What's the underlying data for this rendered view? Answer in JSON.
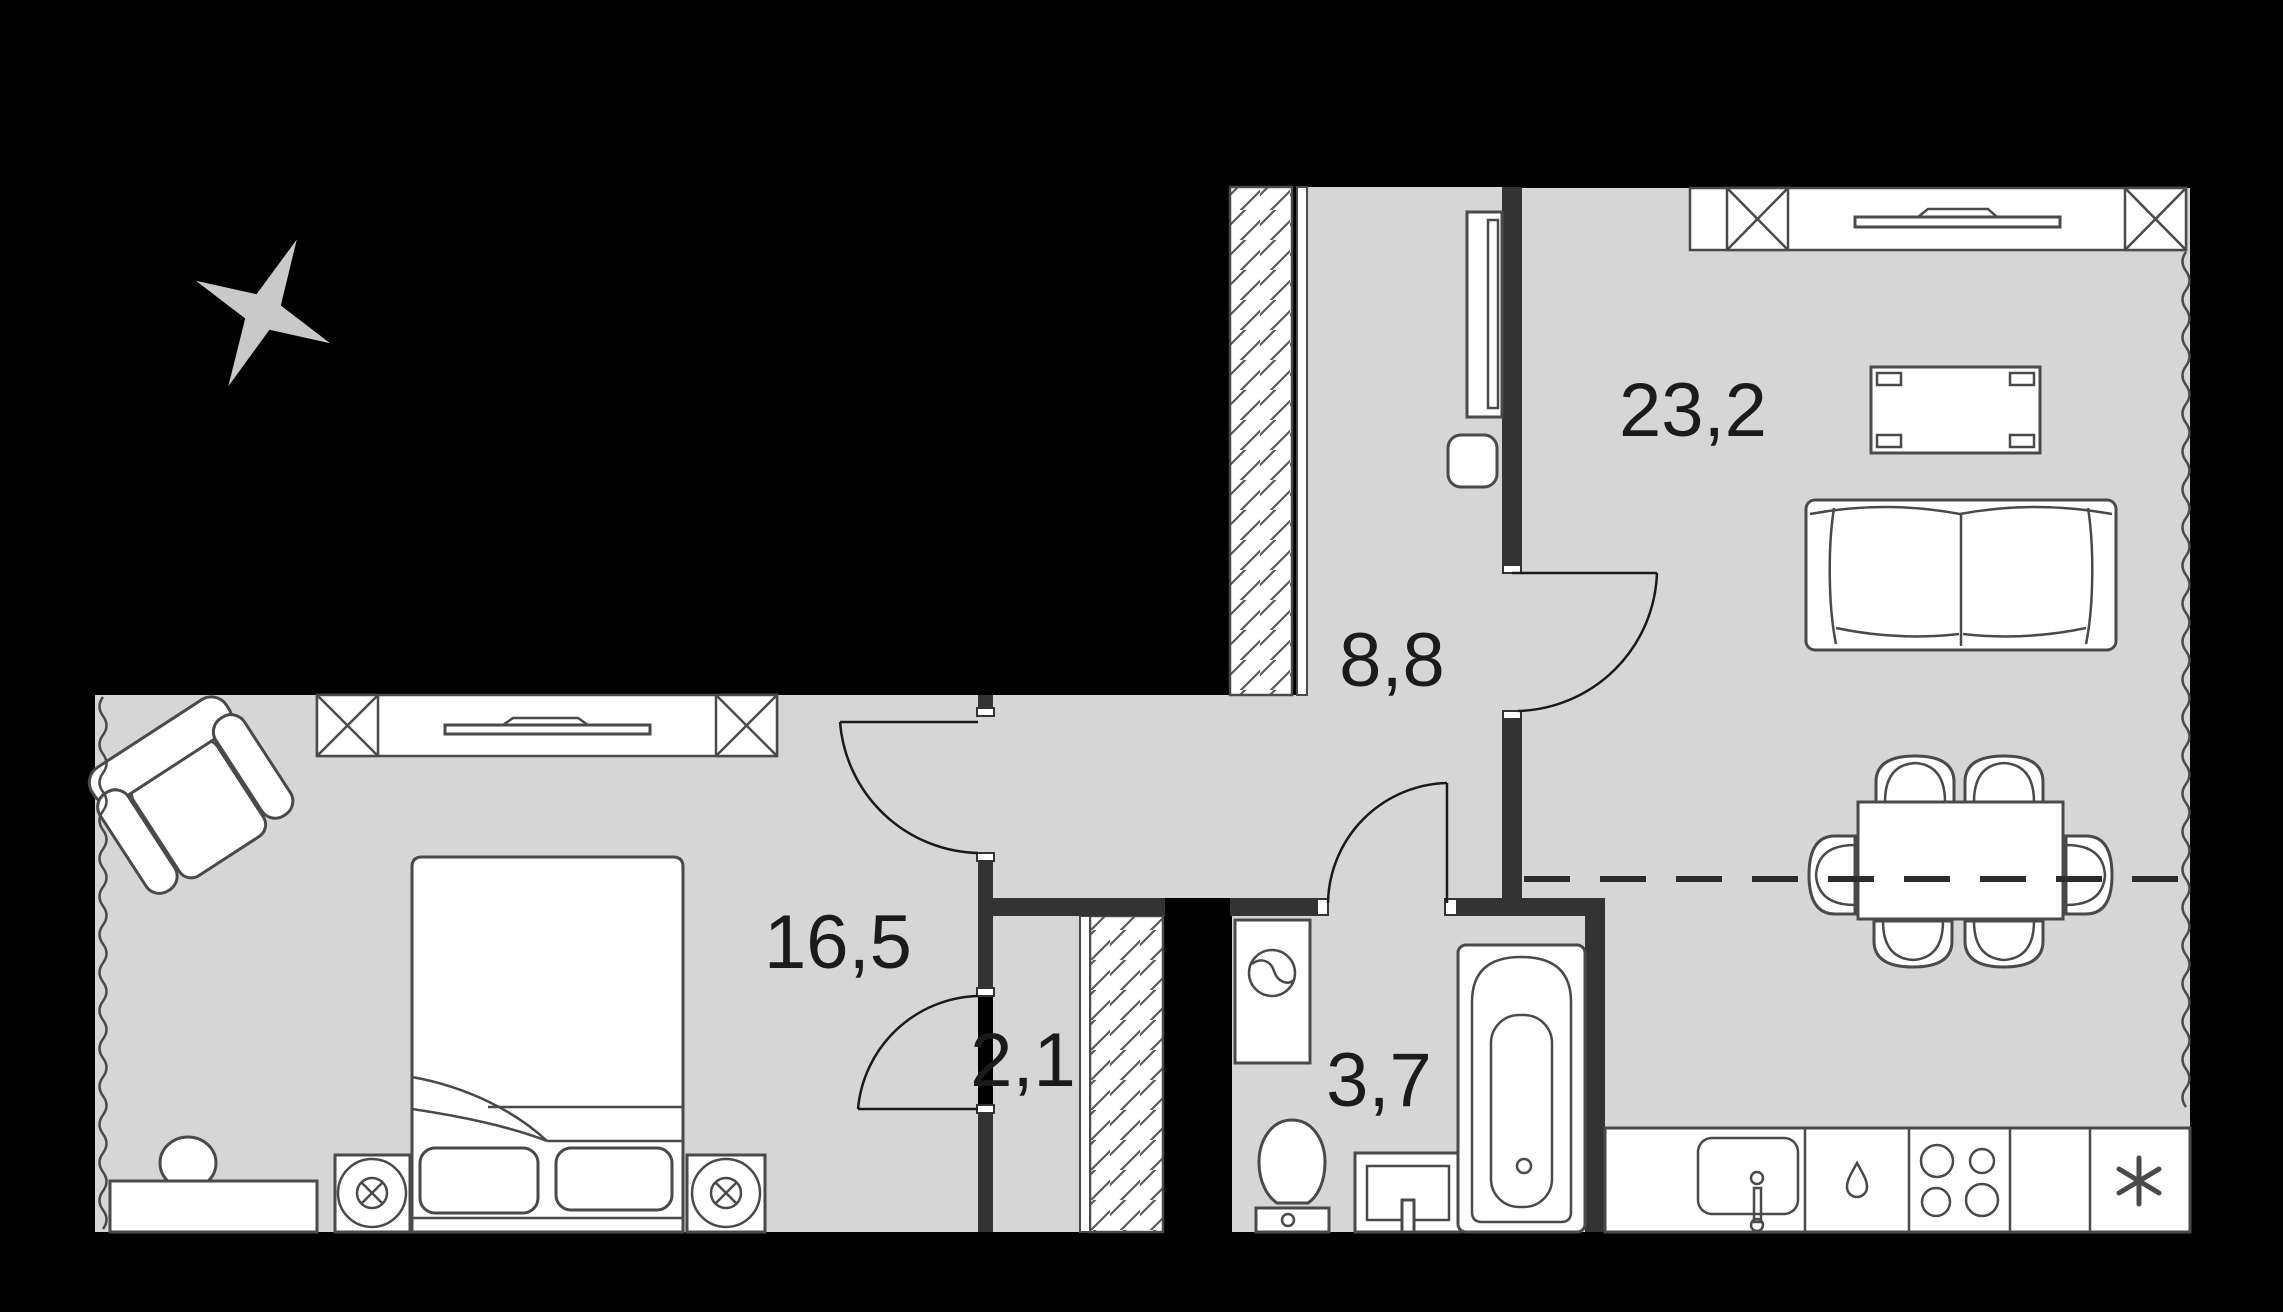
{
  "plan": {
    "type": "apartment-floorplan",
    "rooms": [
      {
        "name": "living-kitchen",
        "area_label": "23,2"
      },
      {
        "name": "hallway",
        "area_label": "8,8"
      },
      {
        "name": "bedroom",
        "area_label": "16,5"
      },
      {
        "name": "closet",
        "area_label": "2,1"
      },
      {
        "name": "bathroom",
        "area_label": "3,7"
      }
    ],
    "icons": [
      "compass-star-icon",
      "bed-icon",
      "nightstand-lamp-icon",
      "desk-icon",
      "armchair-icon",
      "wardrobe-icon",
      "pouf-icon",
      "washing-machine-icon",
      "toilet-icon",
      "vanity-sink-icon",
      "bathtub-icon",
      "kitchen-sink-icon",
      "dishwasher-icon",
      "cooktop-icon",
      "fridge-icon",
      "sofa-icon",
      "coffee-table-icon",
      "dining-table-icon",
      "chair-icon",
      "tv-icon",
      "window-icon"
    ],
    "colors": {
      "background": "#000000",
      "floor": "#d6d6d6",
      "wall": "#333333",
      "outline": "#4a4a4a",
      "compass": "#c9c9c9",
      "label_text": "#1b1b1b"
    }
  }
}
